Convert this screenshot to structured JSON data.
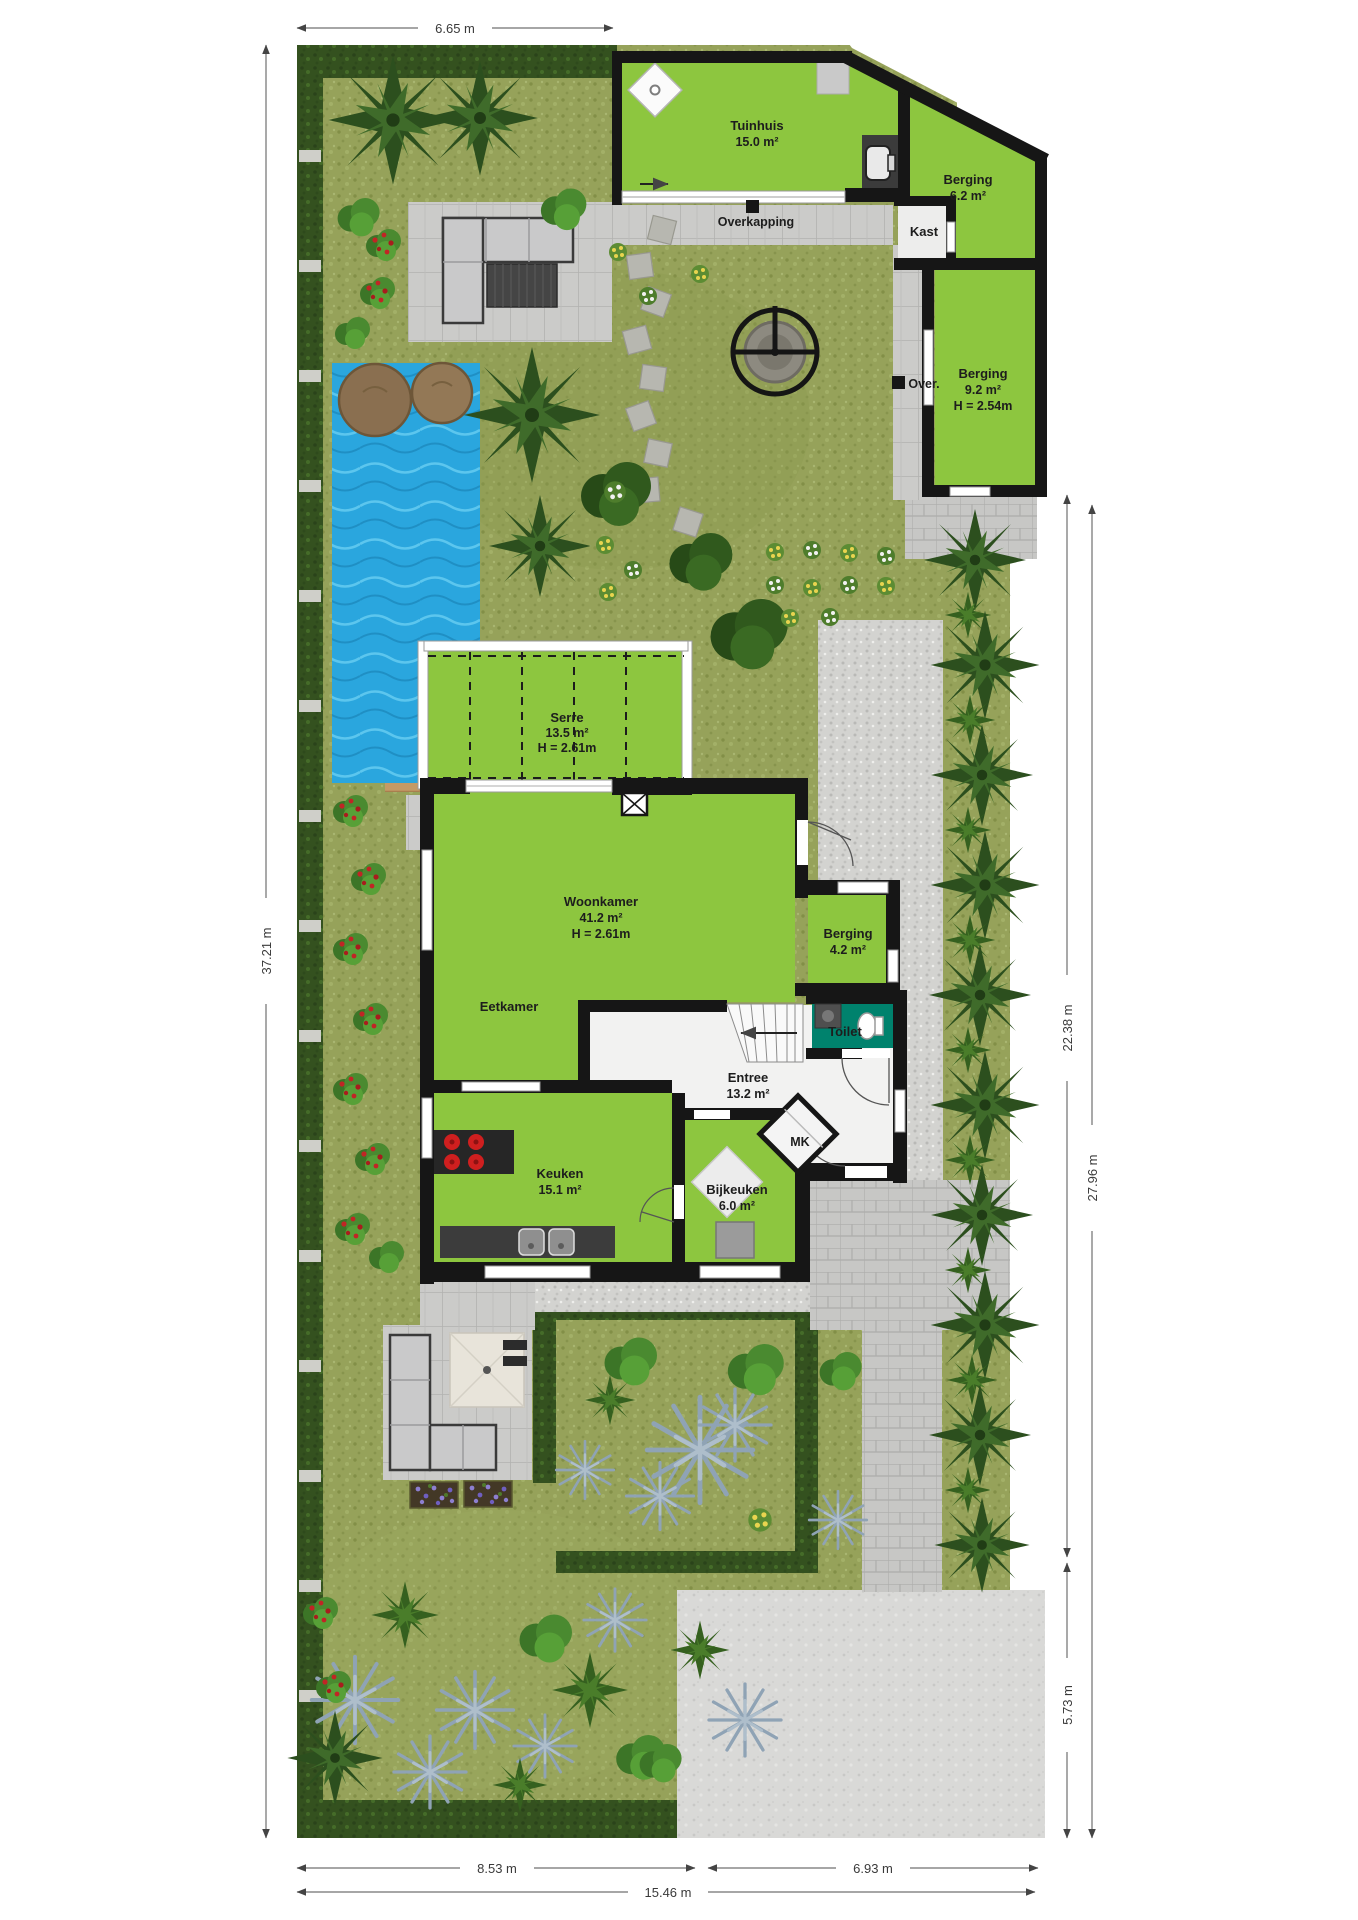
{
  "title": "Tuin- en begane grond plattegrond",
  "rooms": {
    "tuinhuis": {
      "label": "Tuinhuis",
      "area": "15.0 m²"
    },
    "berging_tuin": {
      "label": "Berging",
      "area": "6.2 m²"
    },
    "kast": {
      "label": "Kast"
    },
    "berging_achter": {
      "label": "Berging",
      "area": "9.2 m²",
      "height": "H = 2.54m"
    },
    "serre": {
      "label": "Serre",
      "area": "13.5 m²",
      "height": "H = 2.61m"
    },
    "woonkamer": {
      "label": "Woonkamer",
      "area": "41.2 m²",
      "height": "H = 2.61m"
    },
    "eetkamer": {
      "label": "Eetkamer"
    },
    "berging_huis": {
      "label": "Berging",
      "area": "4.2 m²"
    },
    "toilet": {
      "label": "Toilet"
    },
    "entree": {
      "label": "Entree",
      "area": "13.2 m²"
    },
    "mk": {
      "label": "MK"
    },
    "keuken": {
      "label": "Keuken",
      "area": "15.1 m²"
    },
    "bijkeuken": {
      "label": "Bijkeuken",
      "area": "6.0 m²"
    }
  },
  "annotations": {
    "overkapping": "Overkapping",
    "over": "Over."
  },
  "dimensions": {
    "top_width": "6.65 m",
    "left_height": "37.21 m",
    "right_upper": "22.38 m",
    "right_full": "27.96 m",
    "right_lower": "5.73 m",
    "bottom_left": "8.53 m",
    "bottom_right": "6.93 m",
    "bottom_total": "15.46 m"
  },
  "colors": {
    "room_green": "#8dc63f",
    "toilet_teal": "#00826d",
    "pool_blue": "#2aa6de",
    "grass": "#96a25a",
    "hedge": "#34511f",
    "wall": "#161616",
    "tile_gray": "#cbcbc9",
    "gravel_gray": "#d3d3d0",
    "wood": "#c49a66"
  }
}
